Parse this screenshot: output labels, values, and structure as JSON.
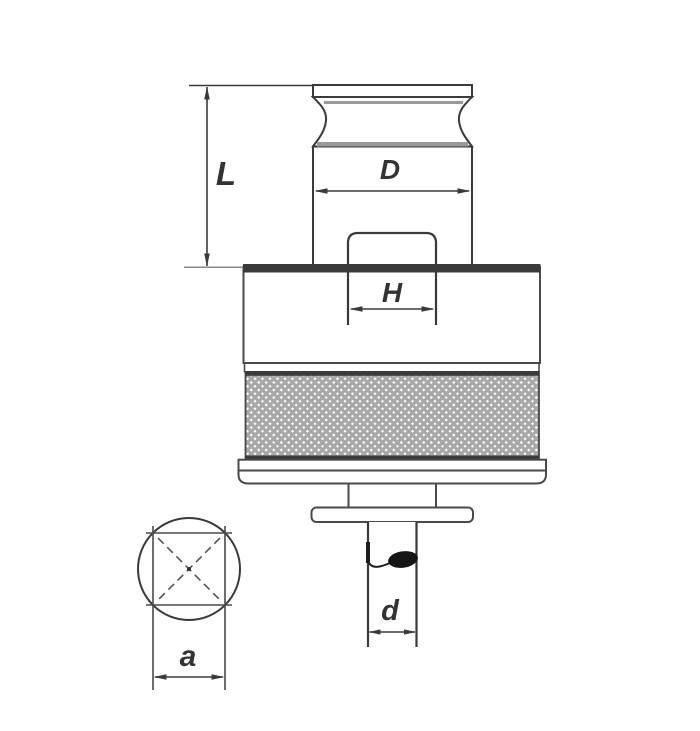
{
  "drawing": {
    "type": "technical-drawing",
    "dimensions": {
      "L": "L",
      "D": "D",
      "H": "H",
      "d": "d",
      "a": "a"
    },
    "colors": {
      "line": "#3a3a3a",
      "dark_edge": "#3a3a3a",
      "accent_gray": "#999999",
      "knurl_gray": "#a8a8a8",
      "ball": "#161616",
      "background": "#ffffff",
      "label": "#333333"
    }
  }
}
